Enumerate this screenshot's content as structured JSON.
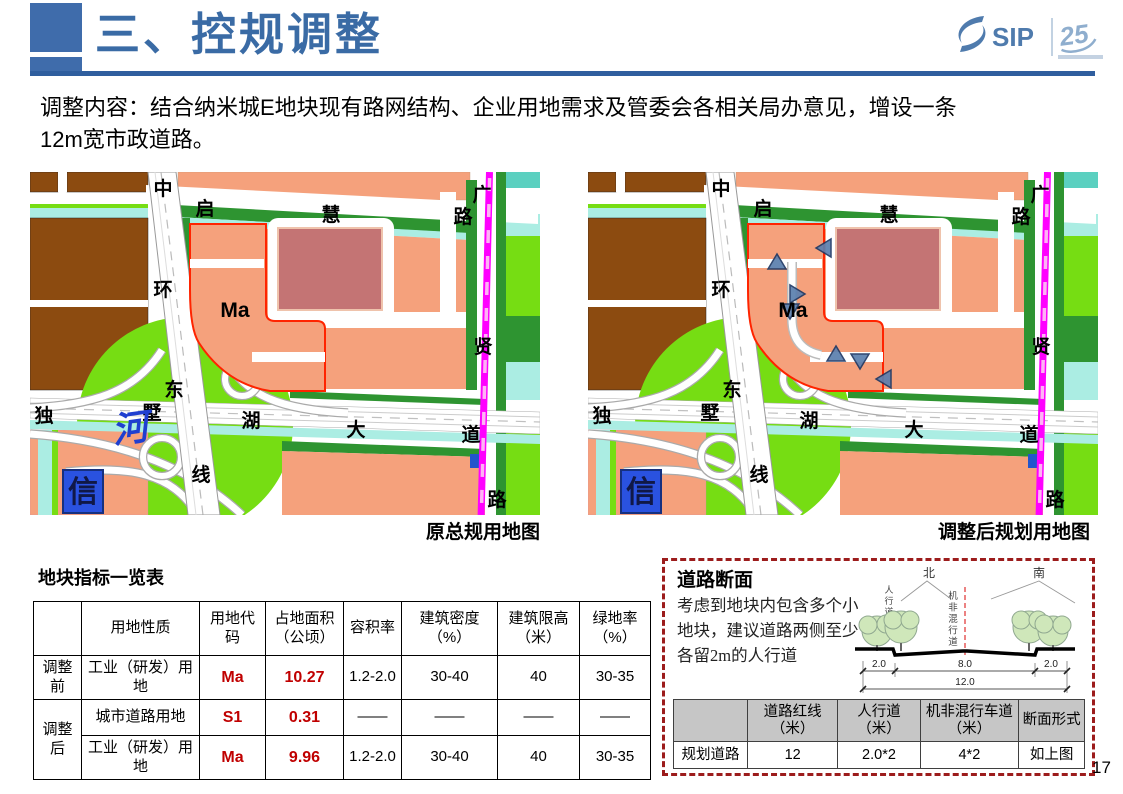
{
  "header": {
    "title": "三、控规调整",
    "logo": {
      "sip_text": "SIP",
      "anniversary_text": "25"
    }
  },
  "intro": {
    "line1": "调整内容：结合纳米城E地块现有路网结构、企业用地需求及管委会各相关局办意见，增设一条",
    "line2": "12m宽市政道路。"
  },
  "maps": {
    "left_caption": "原总规用地图",
    "right_caption": "调整后规划用地图",
    "labels": [
      {
        "text": "中",
        "x": 133,
        "y": 23
      },
      {
        "text": "启",
        "x": 175,
        "y": 43
      },
      {
        "text": "慧",
        "x": 301,
        "y": 49
      },
      {
        "text": "广",
        "x": 452,
        "y": 29
      },
      {
        "text": "路",
        "x": 433,
        "y": 51
      },
      {
        "text": "环",
        "x": 133,
        "y": 124
      },
      {
        "text": "贤",
        "x": 453,
        "y": 181
      },
      {
        "text": "东",
        "x": 144,
        "y": 224
      },
      {
        "text": "独",
        "x": 14,
        "y": 250
      },
      {
        "text": "墅",
        "x": 122,
        "y": 247
      },
      {
        "text": "湖",
        "x": 221,
        "y": 255
      },
      {
        "text": "大",
        "x": 326,
        "y": 264
      },
      {
        "text": "道",
        "x": 441,
        "y": 269
      },
      {
        "text": "线",
        "x": 171,
        "y": 309
      },
      {
        "text": "路",
        "x": 467,
        "y": 334
      }
    ],
    "plot_label": "Ma",
    "blue_sign_text": "信",
    "river_label": "河",
    "arrows": [
      {
        "x": 237,
        "y": 76,
        "dir": "left"
      },
      {
        "x": 189,
        "y": 91,
        "dir": "up"
      },
      {
        "x": 208,
        "y": 122,
        "dir": "right"
      },
      {
        "x": 202,
        "y": 138,
        "dir": "down"
      },
      {
        "x": 248,
        "y": 183,
        "dir": "up"
      },
      {
        "x": 272,
        "y": 188,
        "dir": "down"
      },
      {
        "x": 297,
        "y": 207,
        "dir": "left"
      }
    ]
  },
  "palette": {
    "brown": "#8C4B10",
    "salmon": "#F5A17C",
    "rose": "#C47474",
    "dark_green": "#2E9431",
    "lime": "#76DD13",
    "pale_cyan": "#ABEDE3",
    "teal": "#5BD0C0",
    "magenta": "#FF00FF",
    "magenta_dash": "#FFB3F5",
    "red_outline": "#FF2400",
    "sign_blue": "#2A52E0",
    "arrow_blue": "#5B7FAE",
    "arrow_stroke": "#1F3864",
    "accent_blue": "#3A6BA5",
    "table_red": "#C00000",
    "panel_border": "#9C1C1C"
  },
  "plot_table": {
    "title": "地块指标一览表",
    "headers": [
      "",
      "用地性质",
      "用地代码",
      "占地面积（公顷）",
      "容积率",
      "建筑密度（%）",
      "建筑限高（米）",
      "绿地率（%）"
    ],
    "rows": [
      {
        "stage": "调整前",
        "stage_span": 1,
        "values": [
          "工业（研发）用地",
          "Ma",
          "10.27",
          "1.2-2.0",
          "30-40",
          "40",
          "30-35"
        ],
        "red_cols": [
          1,
          2
        ]
      },
      {
        "stage": "调整后",
        "stage_span": 2,
        "values": [
          "城市道路用地",
          "S1",
          "0.31",
          "——",
          "——",
          "——",
          "——"
        ],
        "red_cols": [
          1,
          2
        ]
      },
      {
        "stage": null,
        "stage_span": 0,
        "values": [
          "工业（研发）用地",
          "Ma",
          "9.96",
          "1.2-2.0",
          "30-40",
          "40",
          "30-35"
        ],
        "red_cols": [
          1,
          2
        ]
      }
    ]
  },
  "road_panel": {
    "title": "道路断面",
    "desc_lines": [
      "考虑到地块内包含多个小",
      "地块，建议道路两侧至少",
      "各留2m的人行道"
    ],
    "diagram": {
      "north": "北",
      "south": "南",
      "left_walk": "人行道",
      "center_lane": "机非混行道",
      "dims": {
        "left": "2.0",
        "mid": "8.0",
        "right": "2.0",
        "total": "12.0"
      }
    },
    "table": {
      "headers": [
        "",
        "道路红线（米）",
        "人行道（米）",
        "机非混行车道（米）",
        "断面形式"
      ],
      "rows": [
        [
          "规划道路",
          "12",
          "2.0*2",
          "4*2",
          "如上图"
        ]
      ]
    }
  },
  "page_number": "17"
}
